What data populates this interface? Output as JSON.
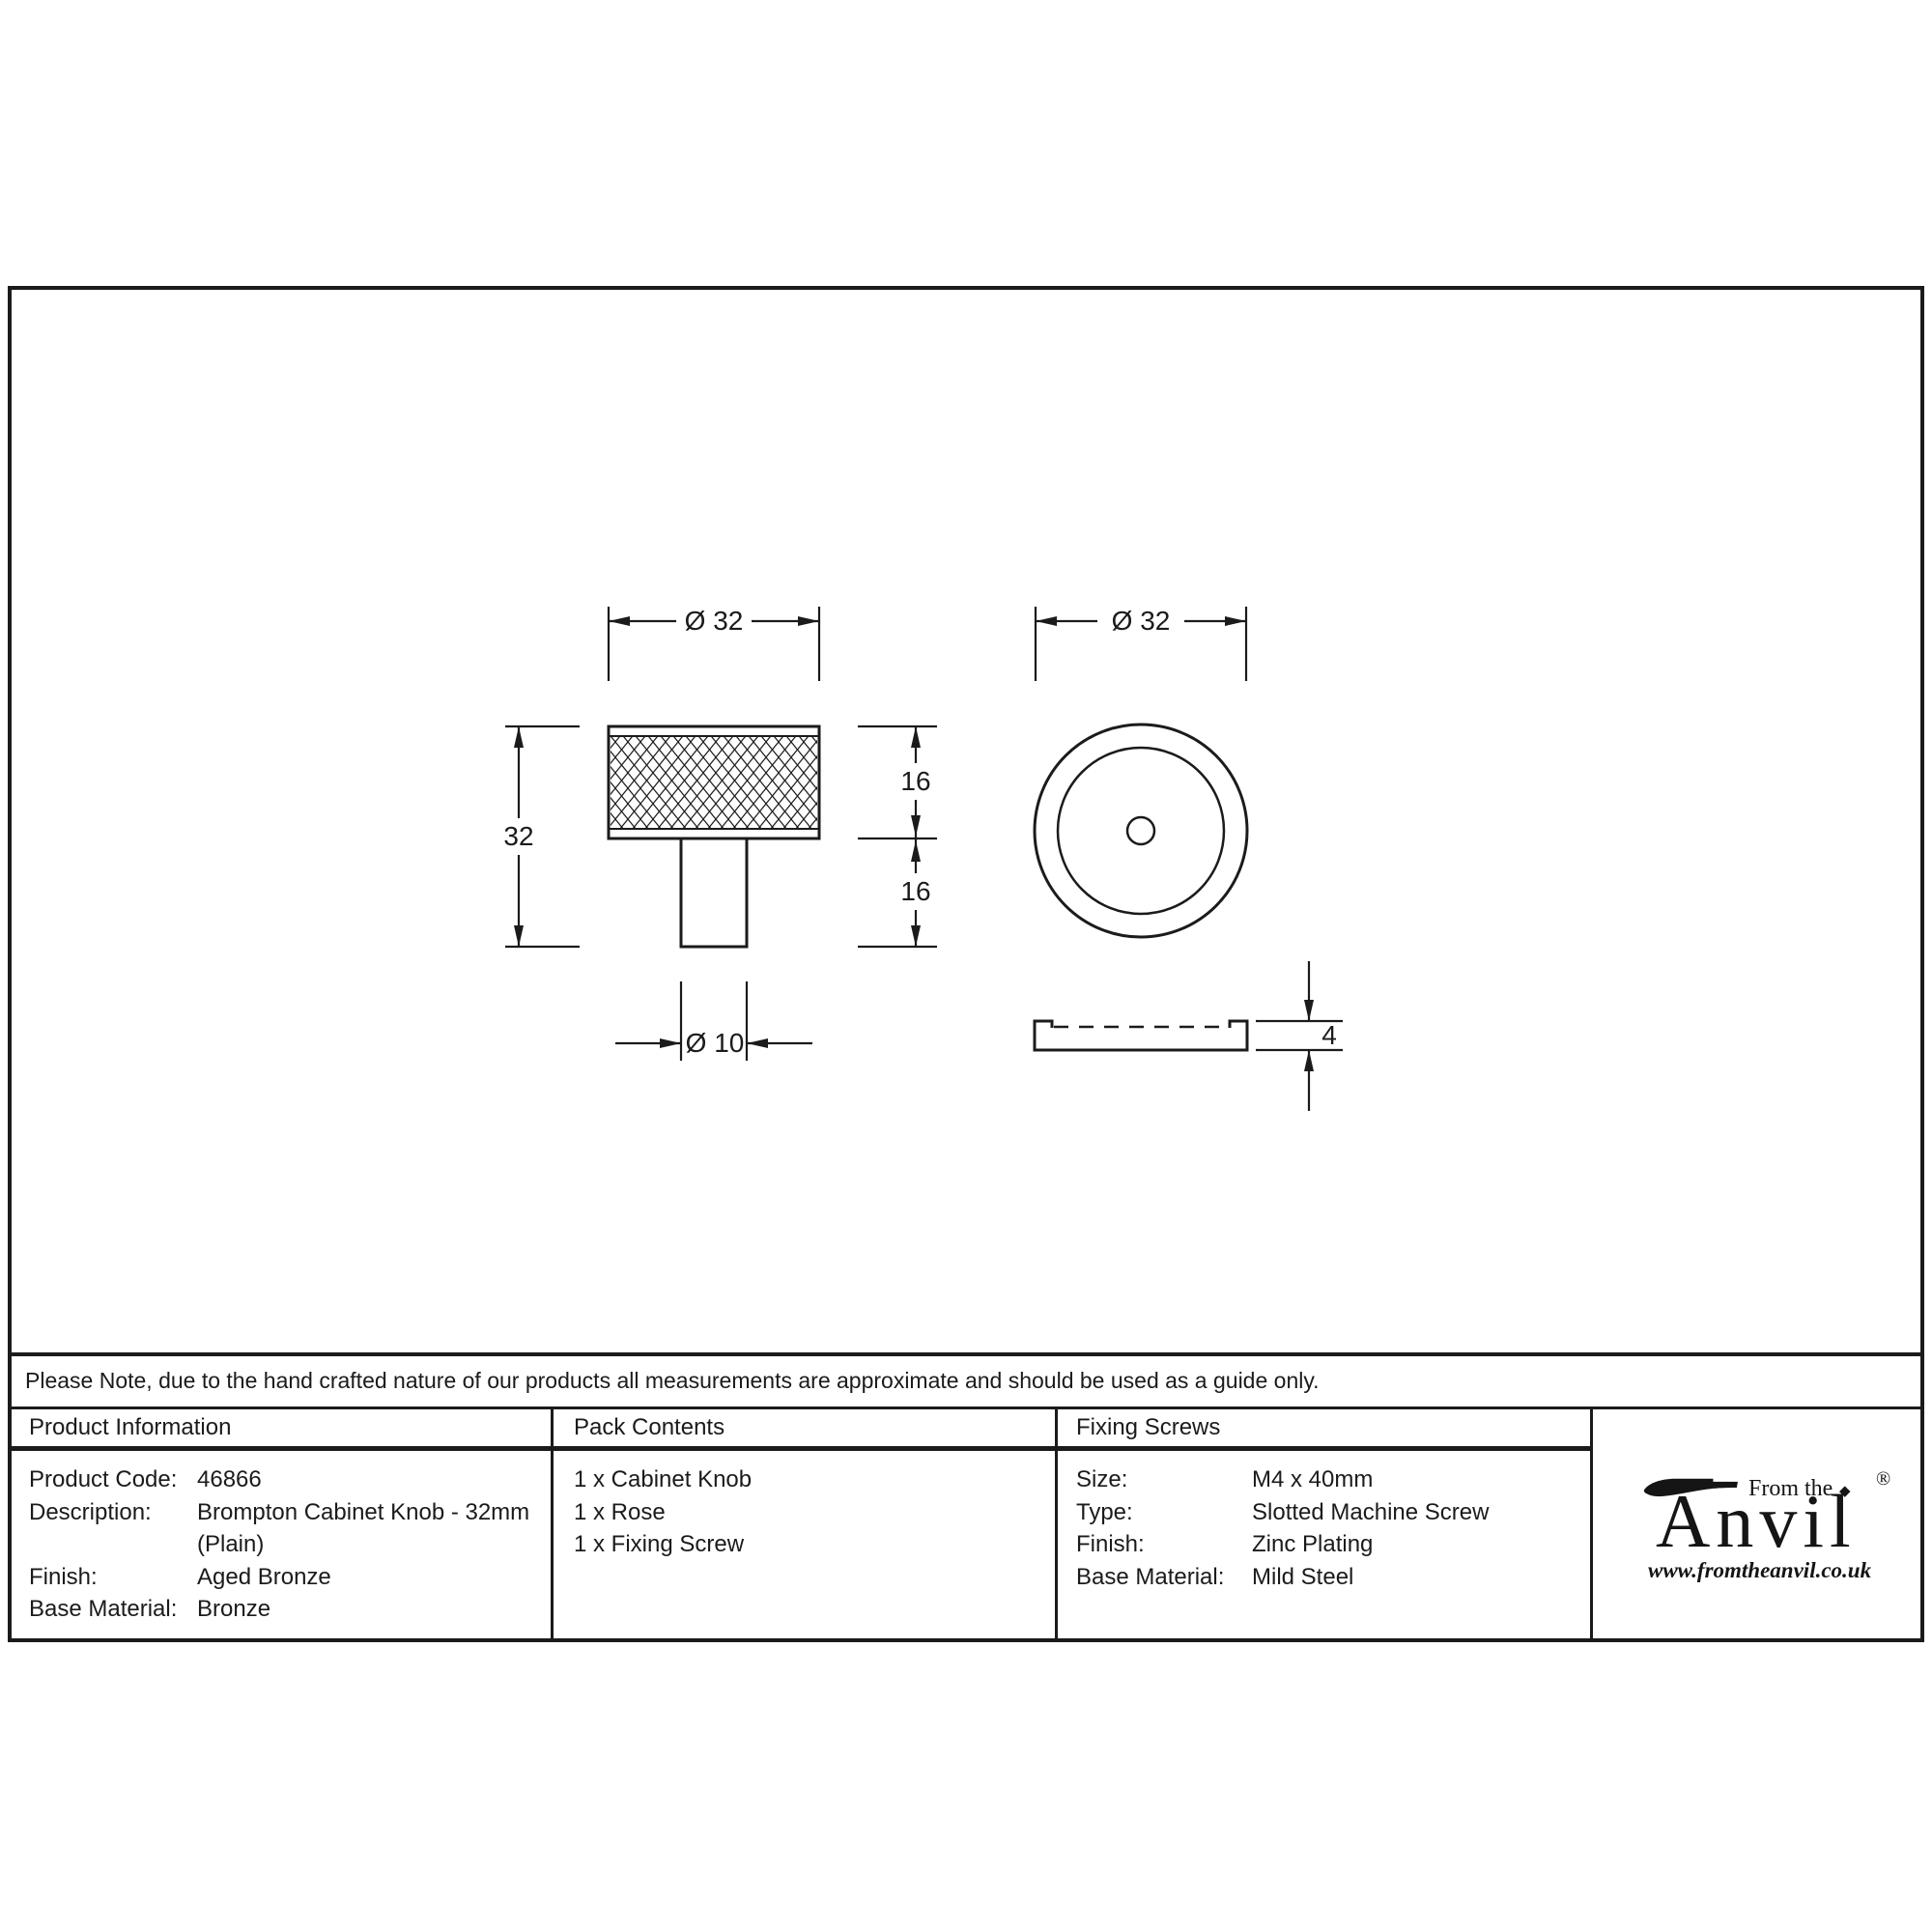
{
  "note": "Please Note, due to the hand crafted nature of our products all measurements are approximate and should be used as a guide only.",
  "drawing": {
    "side_view": {
      "diameter": "Ø 32",
      "height": "32",
      "head_height": "16",
      "stem_height": "16",
      "stem_diameter": "Ø 10"
    },
    "front_view": {
      "diameter": "Ø 32",
      "rose_thickness": "4"
    }
  },
  "table": {
    "product_information": {
      "header": "Product Information",
      "rows": [
        {
          "label": "Product Code:",
          "value": "46866"
        },
        {
          "label": "Description:",
          "value": "Brompton Cabinet Knob - 32mm"
        },
        {
          "label": "",
          "value": "(Plain)"
        },
        {
          "label": "Finish:",
          "value": "Aged Bronze"
        },
        {
          "label": "Base Material:",
          "value": "Bronze"
        }
      ]
    },
    "pack_contents": {
      "header": "Pack Contents",
      "items": [
        "1 x Cabinet Knob",
        "1 x Rose",
        "1 x Fixing Screw"
      ]
    },
    "fixing_screws": {
      "header": "Fixing Screws",
      "rows": [
        {
          "label": "Size:",
          "value": "M4 x 40mm"
        },
        {
          "label": "Type:",
          "value": "Slotted Machine Screw"
        },
        {
          "label": "Finish:",
          "value": "Zinc Plating"
        },
        {
          "label": "Base Material:",
          "value": "Mild Steel"
        }
      ]
    }
  },
  "logo": {
    "tagline": "From the",
    "brand": "Anvil",
    "diamond": "◆",
    "registered": "®",
    "url": "www.fromtheanvil.co.uk"
  },
  "colors": {
    "ink": "#1b1b1b",
    "background": "#ffffff"
  }
}
